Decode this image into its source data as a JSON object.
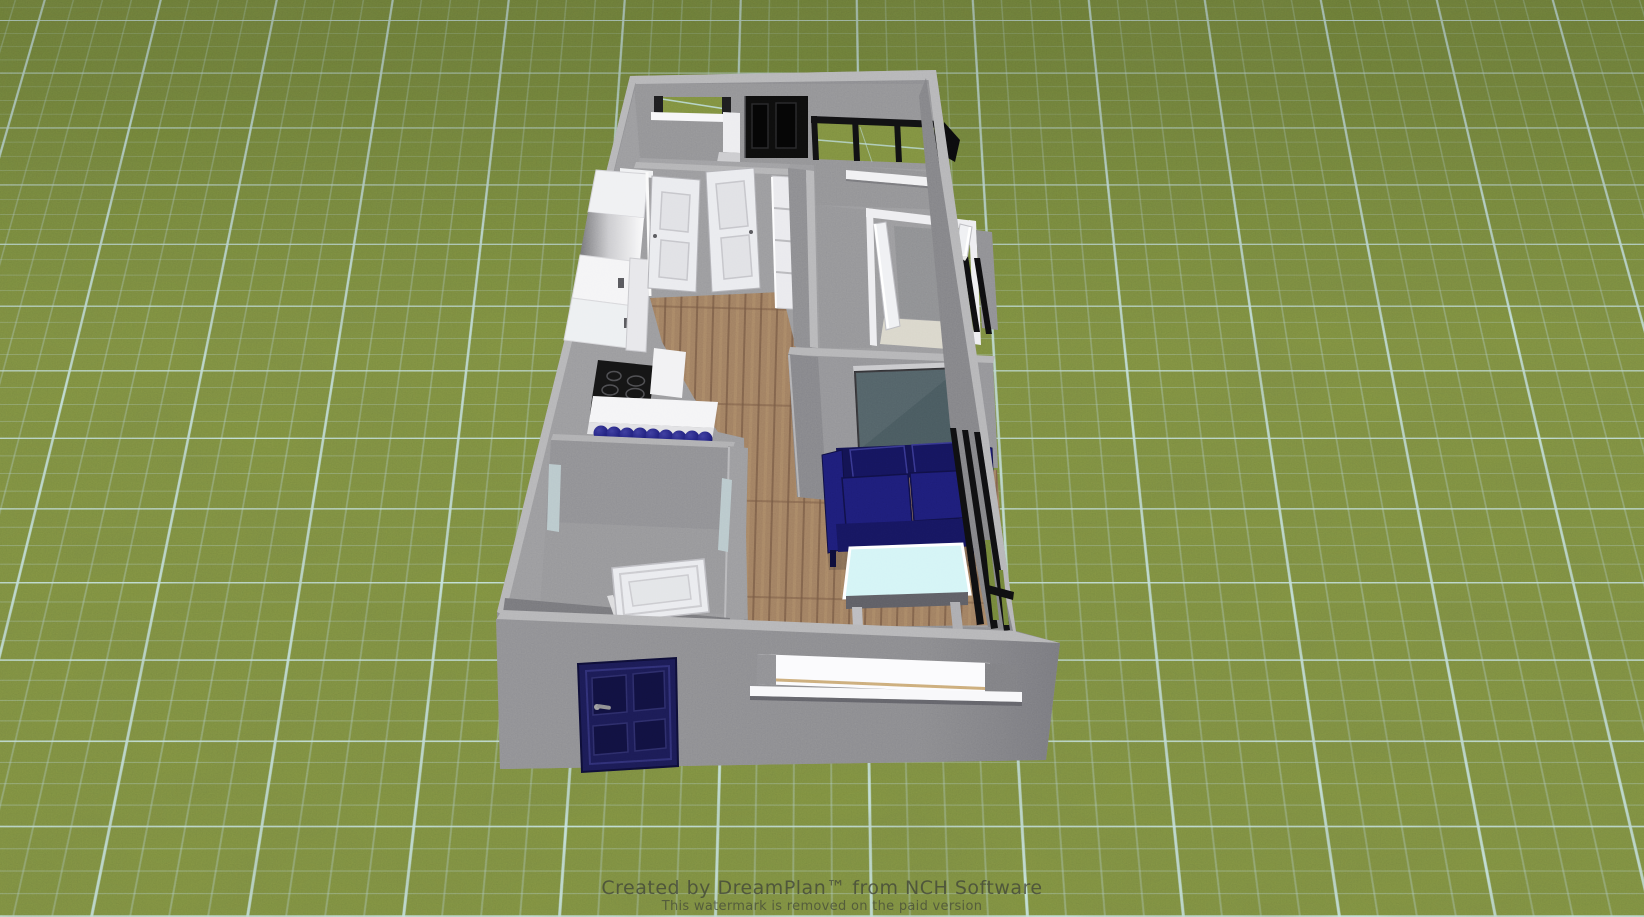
{
  "watermark": {
    "line1": "Created by DreamPlan™ from NCH Software",
    "line2": "This watermark is removed on the paid version"
  },
  "palette": {
    "grass": "#7a8b3e",
    "grass_dark": "#6f8038",
    "grid_major": "#cdeef0",
    "grid_minor": "#bfe3e6",
    "wall_face": "#88888d",
    "wall_top": "#b2b2b5",
    "wall_inner": "#8f8f94",
    "wall_dark": "#77777c",
    "concrete_floor": "#96969a",
    "wood_floor": "#9c7a5e",
    "wood_plank_dark": "#7b5f49",
    "sofa_navy": "#1c1c74",
    "sofa_dark": "#12124f",
    "door_navy": "#1a1a52",
    "door_black": "#0d0d0d",
    "interior_door_white": "#e9eaee",
    "tv_screen": "#46565c",
    "table_glass": "#d2f4f6",
    "closet_carpet": "#d8d5c9",
    "shower_glass": "#b6c6ca",
    "window_white": "#fbfbfd",
    "sill_tan": "#c9a876"
  },
  "objects": [
    "exterior-walls",
    "back-window",
    "back-black-door",
    "sliding-glass-door",
    "kitchen-cabinets",
    "refrigerator",
    "cooktop",
    "banquette-bench",
    "interior-door-left",
    "interior-door-right",
    "hall-shelf-unit",
    "closet",
    "closet-double-doors",
    "closet-carpet",
    "media-wall",
    "tv",
    "sofa",
    "coffee-table",
    "bathroom",
    "bathroom-door",
    "shower-glass",
    "front-door",
    "front-window",
    "right-wall-windows",
    "wood-floor"
  ]
}
